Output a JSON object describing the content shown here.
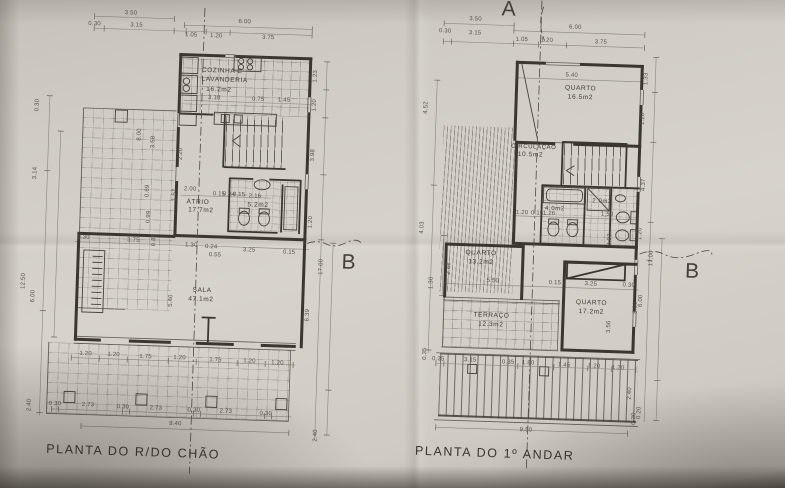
{
  "photo": {
    "paper": "#d7d3cc",
    "ink": "#3b372f",
    "dim_ink": "#565148"
  },
  "gf": {
    "title": "PLANTA DO R/DO CHÃO",
    "section_b": "B",
    "rooms": {
      "cozinha1": "COZINHA E",
      "cozinha2": "LAVANDERIA",
      "cozinha_area": "16.2m2",
      "atrio": "ÁTRIO",
      "atrio_area": "17.7m2",
      "wc_area": "5.2m2",
      "sala": "SALA",
      "sala_area": "47.1m2"
    },
    "top": [
      "3.50",
      "0.30",
      "3.15",
      "6.00",
      "1.05",
      "1.20",
      "3.75"
    ],
    "kitchen": [
      "3.18",
      "0.75",
      "1.45"
    ],
    "hall": [
      "2.00",
      "0.15",
      "0.84",
      "0.15",
      "2.16"
    ],
    "mid": [
      "0.30",
      "3.75",
      "1.30",
      "0.24",
      "3.25",
      "0.55",
      "5.40",
      "0.15"
    ],
    "sala_bottom": [
      "1.20",
      "1.20",
      "1.75",
      "1.20",
      "1.75",
      "1.20",
      "1.20"
    ],
    "porch": [
      "0.30",
      "2.73",
      "0.30",
      "2.73",
      "0.30",
      "2.73",
      "0.30"
    ],
    "total": "9.40",
    "left": [
      "0.30",
      "3.14",
      "12.50",
      "6.00",
      "2.40"
    ],
    "right": [
      "1.23",
      "1.20",
      "3.98",
      "1.20",
      "17.00",
      "6.39",
      "2.40"
    ],
    "left_inner": [
      "8.00",
      "3.58",
      "2.20",
      "1.57",
      "0.69",
      "0.99",
      "0.88"
    ]
  },
  "ff": {
    "title": "PLANTA DO 1º ANDAR",
    "section_a": "A",
    "section_b": "B",
    "rooms": {
      "quarto1": "QUARTO",
      "quarto1_area": "16.5m2",
      "circ": "CIRCULAÇÃO",
      "circ_area": "10.5m2",
      "wc1_area": "4.0m2",
      "wc2_area": "2.0m2",
      "quarto2": "QUARTO",
      "quarto2_area": "13.2m2",
      "terraco": "TERRAÇO",
      "terraco_area": "12.3m2",
      "quarto3": "QUARTO",
      "quarto3_area": "17.2m2"
    },
    "top": [
      "3.50",
      "0.30",
      "3.15",
      "6.00",
      "1.05",
      "1.20",
      "3.75"
    ],
    "inner": [
      "5.40",
      "1.20",
      "0.15",
      "1.26",
      "1.50",
      "5.50",
      "0.15",
      "3.25",
      "0.30",
      "3.07",
      "3.56",
      "8.00",
      "2.88"
    ],
    "bottom": [
      "0.35",
      "3.15",
      "0.35",
      "1.80",
      "1.45",
      "1.20",
      "1.20"
    ],
    "total": "9.50",
    "left": [
      "4.52",
      "4.03",
      "1.30",
      "0.35"
    ],
    "right": [
      "1.33",
      "1.20",
      "4.37",
      "1.20",
      "17.00",
      "6.00",
      "2.40",
      "0.20",
      "0.30"
    ]
  }
}
